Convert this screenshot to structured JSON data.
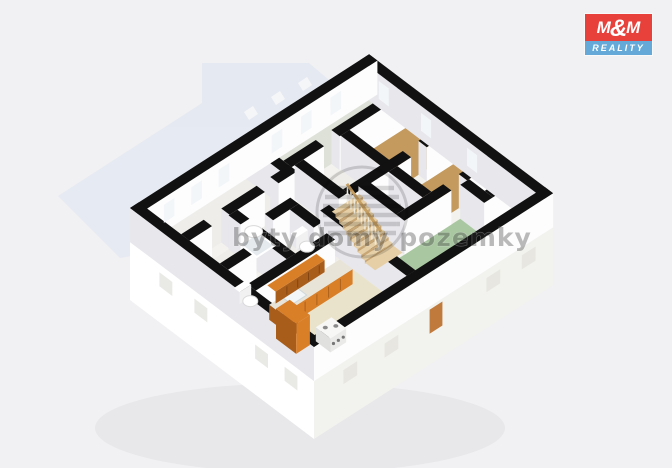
{
  "logo": {
    "m_left": "M",
    "ampersand": "&",
    "m_right": "M",
    "reality": "REALITY"
  },
  "watermark": {
    "text": "byty domy pozemky"
  },
  "palette": {
    "background": "#f1f1f3",
    "ghost_floor": "#dde4f0",
    "shadow": "#d8d8dd",
    "wall": "#111111",
    "wall_face": "#fdfdfd",
    "wall_face_shade": "#e7e7ec",
    "plinth_west": "#ffffff",
    "plinth_south": "#f2f2ee",
    "floor_base": "#f3f2ee",
    "floor_white": "#eeede9",
    "floor_pale": "#dde1d7",
    "floor_tan": "#c49a5e",
    "floor_green": "#a9c8a1",
    "floor_beige": "#eae3cc",
    "kitchen_orange": "#d97f28",
    "kitchen_orange_dark": "#a85d1b",
    "counter_top": "#e9e4d8",
    "stair_wood": "#e6cfa6",
    "stair_riser": "#c8a775",
    "rail_wood": "#c69f63",
    "window_slot": "#f3f6f9",
    "entry_door": "#c07a3c",
    "logo_red": "#e8403a",
    "logo_blue": "#64a9d8"
  }
}
